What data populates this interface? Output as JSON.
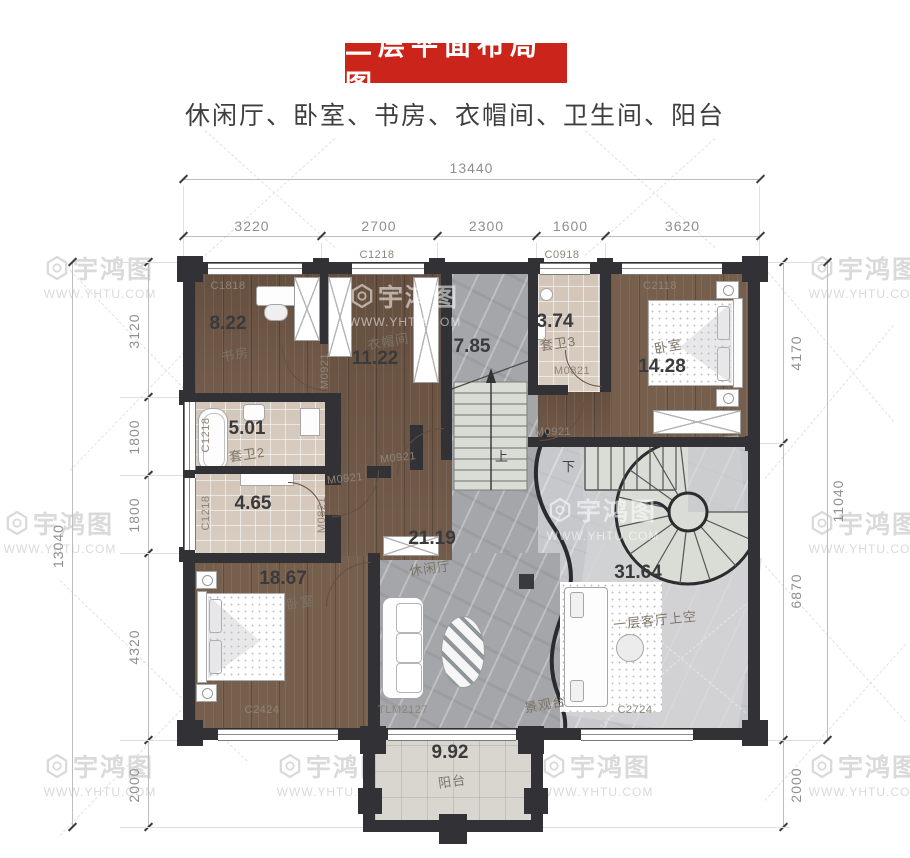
{
  "title": "二层平面布局图",
  "subtitle": "休闲厅、卧室、书房、衣帽间、卫生间、阳台",
  "watermark": {
    "name": "宇鸿图",
    "url": "WWW.YHTU.COM"
  },
  "colors": {
    "banner_red": "#cb241a",
    "wall_dark": "#313136",
    "wood_floor": "#6d5544",
    "stone_floor": "#a4a6aa",
    "bath_tile": "#dbd0c5"
  },
  "dimensions": {
    "top_total": "13440",
    "top_segments": [
      "3220",
      "2700",
      "2300",
      "1600",
      "3620"
    ],
    "left_total": "13040",
    "left_segments": [
      "3120",
      "1800",
      "1800",
      "4320",
      "2000"
    ],
    "right_total": "11040",
    "right_segments": [
      "4170",
      "6870",
      "2000"
    ]
  },
  "rooms": {
    "study": {
      "name": "书房",
      "area": "8.22"
    },
    "cloak": {
      "name": "衣帽间",
      "area": "11.22"
    },
    "stairhall": {
      "area": "7.85"
    },
    "bath3": {
      "name": "套卫3",
      "area": "3.74"
    },
    "bedroom_ne": {
      "name": "卧室",
      "area": "14.28"
    },
    "bath2": {
      "name": "套卫2",
      "area": "5.01"
    },
    "store": {
      "area": "4.65"
    },
    "bedroom_sw": {
      "name": "卧室",
      "area": "18.67"
    },
    "lounge": {
      "name": "休闲厅",
      "area": "21.19"
    },
    "void": {
      "name": "一层客厅上空",
      "area": "31.64"
    },
    "viewdeck": {
      "name": "景观台"
    },
    "balcony": {
      "name": "阳台",
      "area": "9.92"
    }
  },
  "codes": {
    "c1818": "C1818",
    "c1218": "C1218",
    "c0918": "C0918",
    "c2118": "C2118",
    "c2424": "C2424",
    "c2724": "C2724",
    "tlm2127": "TLM2127",
    "m0921": "M0921",
    "m0821": "M0821"
  },
  "stairs": {
    "up": "上",
    "down": "下"
  }
}
